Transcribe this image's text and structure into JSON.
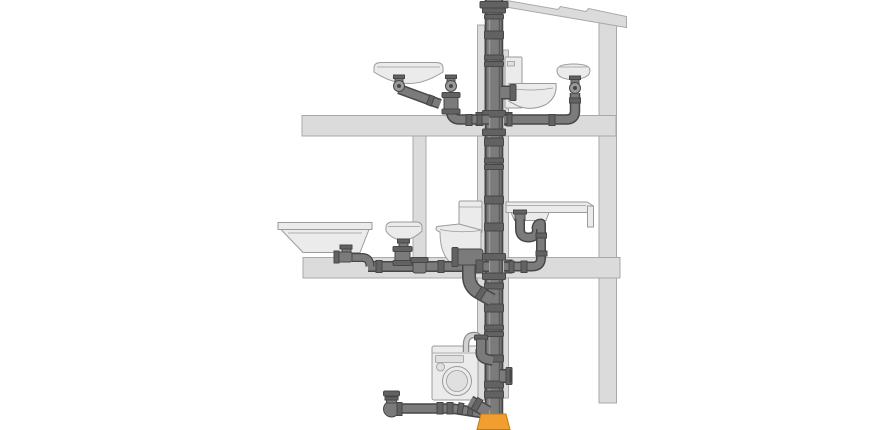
{
  "diagram": {
    "kind": "building-drainage-system-cutaway",
    "components": [
      "roof-vent-stack",
      "main-soil-stack",
      "upper-washbasin-left",
      "upper-wall-hung-toilet",
      "upper-washbasin-right",
      "upper-branch-left",
      "upper-branch-right",
      "upper-toilet-branch",
      "bathtub",
      "lower-washbasin",
      "lower-toilet",
      "kitchen-sink-counter",
      "lower-branch-left",
      "lower-branch-right",
      "toilet-connector-bend",
      "washing-machine",
      "washing-machine-standpipe",
      "stack-side-outlet",
      "basement-branch-pipe",
      "basement-end-fitting",
      "underground-transition-socket",
      "upper-floor-slab",
      "lower-floor-slab",
      "interior-wall",
      "right-wall",
      "roof-beam",
      "pipe-shaft"
    ]
  },
  "colors": {
    "background": "#FFFFFF",
    "wall": "#DBDBDB",
    "wall_stroke": "#A9A9A9",
    "fixture": "#EBEBEB",
    "fixture_stroke": "#9B9B9B",
    "fixture_inset": "#E0E0E0",
    "pipe": "#7B7B7B",
    "pipe_outline": "#474747",
    "pipe_light": "#9A9A9A",
    "pipe_shadow": "#5A5A5A",
    "coupling": "#626262",
    "hose": "#D2D2D2",
    "hose_stroke": "#8A8A8A",
    "orange": "#F09E2F",
    "orange_stroke": "#C27C17"
  }
}
